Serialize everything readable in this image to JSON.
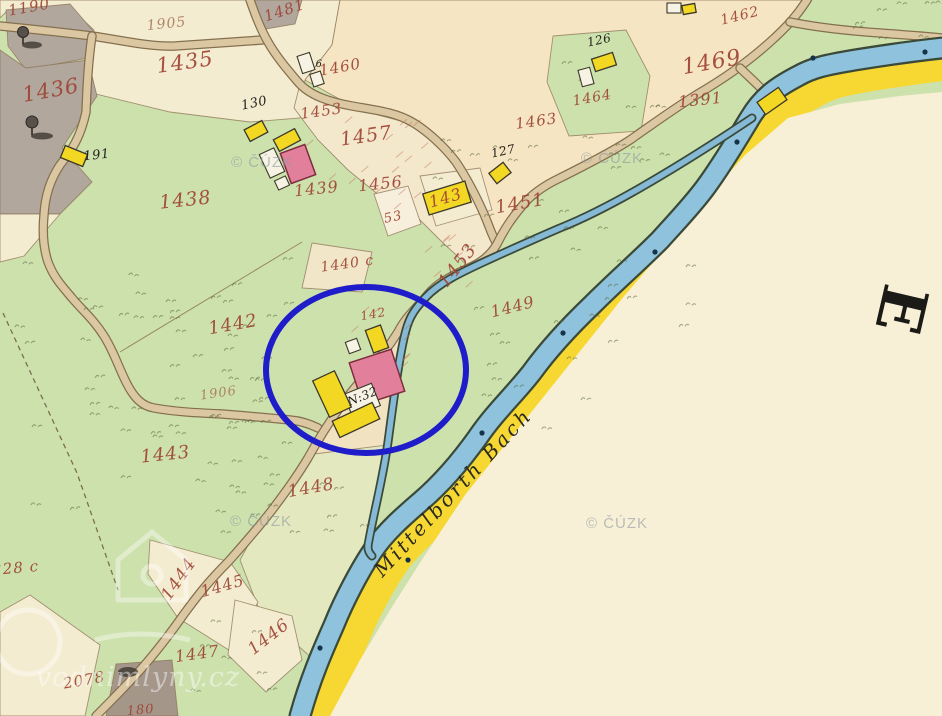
{
  "colors": {
    "meadow_green": "#cde1ad",
    "farmland_cream": "#f4ecd0",
    "farmland_peach": "#f6e5c2",
    "bare_cream": "#f8f0d6",
    "forest_gray": "#b2a79d",
    "stream_blue": "#8fc2dc",
    "road_tan": "#dbc8a2",
    "road_band_yellow": "#f7d832",
    "building_yellow": "#f2d723",
    "building_pink": "#e2809c",
    "building_white": "#f7f3e4",
    "annotation_blue": "#1f1cc9",
    "parcel_number_red": "#9e4434",
    "label_black": "#24231f",
    "watermark_gray": "#8f99a4"
  },
  "map": {
    "stream_label": {
      "text": "Mittelborth Bach",
      "x": 458,
      "y": 497,
      "rot": -47
    },
    "section_letter": {
      "text": "E",
      "x": 896,
      "y": 308,
      "rot": 103
    },
    "annotation_circle": {
      "cx": 366,
      "cy": 370,
      "rx": 100,
      "ry": 83,
      "color": "#1f1cc9"
    },
    "watermarks": {
      "cuzk_text": "© ČÚZK",
      "cuzk_positions": [
        {
          "x": 262,
          "y": 167
        },
        {
          "x": 612,
          "y": 163
        },
        {
          "x": 261,
          "y": 526
        },
        {
          "x": 617,
          "y": 528
        }
      ],
      "site_text": "vodnimlyny.cz",
      "site_x": 138,
      "site_y": 686
    },
    "parcel_labels": [
      {
        "t": "1190",
        "x": 30,
        "y": 12,
        "r": -10,
        "s": 15
      },
      {
        "t": "1435",
        "x": 186,
        "y": 69,
        "r": -8,
        "s": 21
      },
      {
        "t": "1436",
        "x": 52,
        "y": 97,
        "r": -10,
        "s": 21
      },
      {
        "t": "1481",
        "x": 286,
        "y": 15,
        "r": -18,
        "s": 15
      },
      {
        "t": "1438",
        "x": 186,
        "y": 206,
        "r": -6,
        "s": 19
      },
      {
        "t": "1460",
        "x": 341,
        "y": 72,
        "r": -10,
        "s": 15
      },
      {
        "t": "1453",
        "x": 322,
        "y": 116,
        "r": -8,
        "s": 15
      },
      {
        "t": "1457",
        "x": 367,
        "y": 142,
        "r": -8,
        "s": 19
      },
      {
        "t": "1439",
        "x": 317,
        "y": 194,
        "r": -6,
        "s": 16
      },
      {
        "t": "1456",
        "x": 381,
        "y": 189,
        "r": -6,
        "s": 16
      },
      {
        "t": "53",
        "x": 394,
        "y": 221,
        "r": -12,
        "s": 13
      },
      {
        "t": "143",
        "x": 447,
        "y": 203,
        "r": -16,
        "s": 16
      },
      {
        "t": "1451",
        "x": 521,
        "y": 209,
        "r": -10,
        "s": 18
      },
      {
        "t": "1463",
        "x": 537,
        "y": 126,
        "r": -8,
        "s": 15
      },
      {
        "t": "1464",
        "x": 593,
        "y": 102,
        "r": -10,
        "s": 14
      },
      {
        "t": "1462",
        "x": 741,
        "y": 20,
        "r": -14,
        "s": 14
      },
      {
        "t": "1469",
        "x": 713,
        "y": 69,
        "r": -10,
        "s": 22
      },
      {
        "t": "1391",
        "x": 701,
        "y": 105,
        "r": -6,
        "s": 16
      },
      {
        "t": "1442",
        "x": 234,
        "y": 330,
        "r": -10,
        "s": 18
      },
      {
        "t": "1443",
        "x": 166,
        "y": 460,
        "r": -6,
        "s": 18
      },
      {
        "t": "1440 c",
        "x": 348,
        "y": 268,
        "r": -8,
        "s": 14
      },
      {
        "t": "142",
        "x": 374,
        "y": 318,
        "r": -10,
        "s": 12
      },
      {
        "t": "1449",
        "x": 514,
        "y": 312,
        "r": -14,
        "s": 16
      },
      {
        "t": "1453",
        "x": 462,
        "y": 269,
        "r": -52,
        "s": 18
      },
      {
        "t": "1448",
        "x": 312,
        "y": 493,
        "r": -10,
        "s": 17
      },
      {
        "t": "1444",
        "x": 183,
        "y": 582,
        "r": -55,
        "s": 17
      },
      {
        "t": "1445",
        "x": 224,
        "y": 591,
        "r": -16,
        "s": 16
      },
      {
        "t": "1446",
        "x": 272,
        "y": 641,
        "r": -38,
        "s": 17
      },
      {
        "t": "1447",
        "x": 198,
        "y": 659,
        "r": -8,
        "s": 16
      },
      {
        "t": "2078",
        "x": 85,
        "y": 685,
        "r": -10,
        "s": 15
      },
      {
        "t": "228 c",
        "x": 16,
        "y": 573,
        "r": -5,
        "s": 15
      },
      {
        "t": "180",
        "x": 141,
        "y": 714,
        "r": -5,
        "s": 13
      }
    ],
    "road_labels": [
      {
        "t": "1905",
        "x": 167,
        "y": 28,
        "r": -6,
        "s": 14
      },
      {
        "t": "1906",
        "x": 219,
        "y": 397,
        "r": -8,
        "s": 13
      }
    ],
    "house_labels": [
      {
        "t": "130",
        "x": 255,
        "y": 107,
        "r": -12,
        "s": 13
      },
      {
        "t": "191",
        "x": 97,
        "y": 159,
        "r": -6,
        "s": 13
      },
      {
        "t": "126",
        "x": 600,
        "y": 44,
        "r": -12,
        "s": 12
      },
      {
        "t": "127",
        "x": 504,
        "y": 155,
        "r": -12,
        "s": 12
      },
      {
        "t": "6",
        "x": 319,
        "y": 67,
        "r": 0,
        "s": 10
      },
      {
        "t": "N:32",
        "x": 364,
        "y": 400,
        "r": -22,
        "s": 12
      }
    ]
  }
}
